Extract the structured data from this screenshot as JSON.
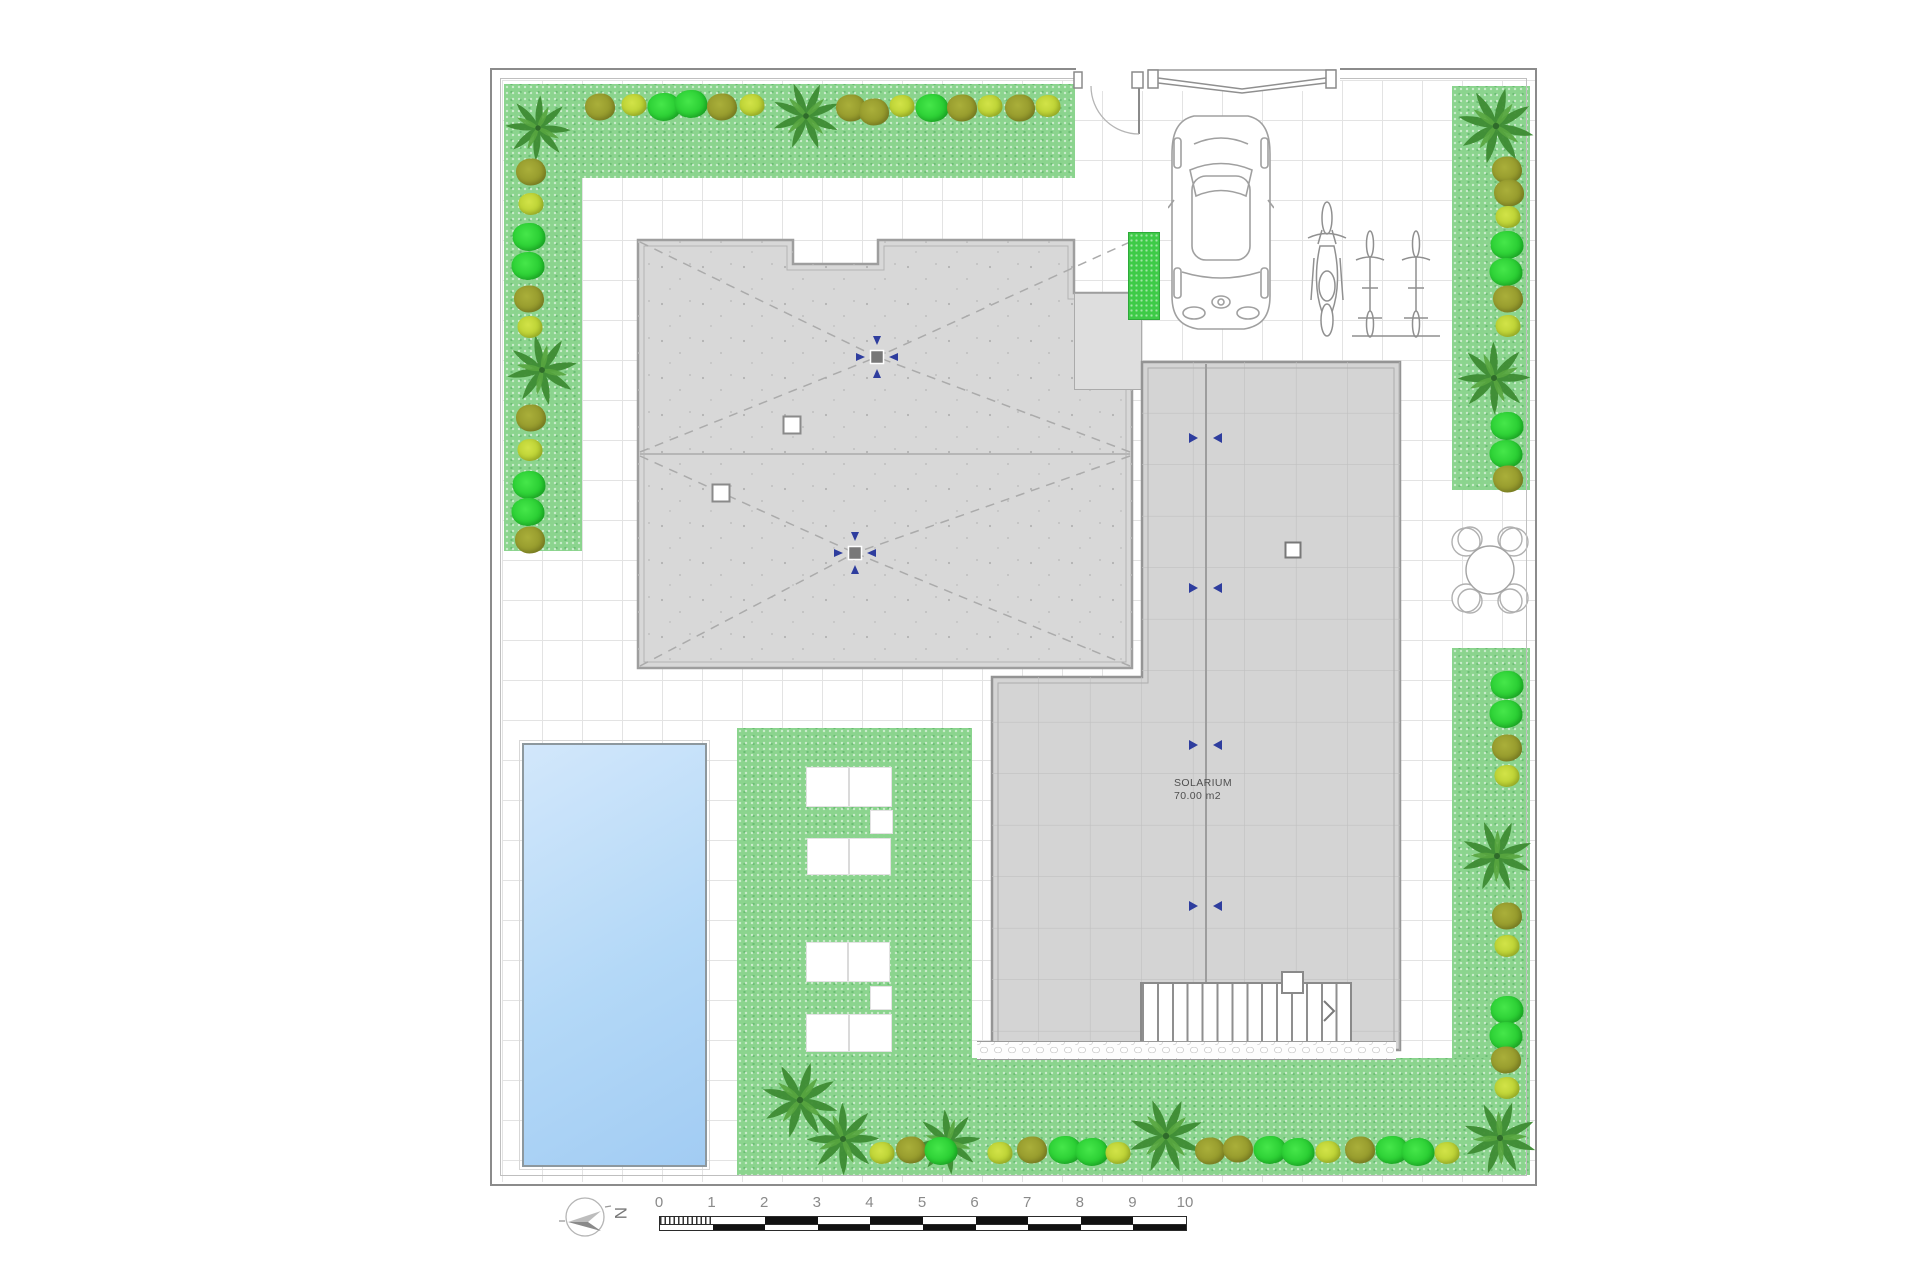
{
  "solarium": {
    "label": "SOLARIUM",
    "area": "70.00 m2"
  },
  "north": {
    "label": "N"
  },
  "scale_bar": {
    "ticks": [
      "0",
      "1",
      "2",
      "3",
      "4",
      "5",
      "6",
      "7",
      "8",
      "9",
      "10"
    ]
  },
  "colors": {
    "grass_green": "#8bd48e",
    "shrub_olive": "#98a02e",
    "shrub_lime": "#bdd334",
    "shrub_bright_green": "#2fd838",
    "palm_green": "#3e8c33",
    "pool_blue": "#b3d8f7",
    "roof_gray": "#d8d8d8",
    "terrace_gray": "#d4d4d4",
    "vent_arrow_blue": "#2e3d9e",
    "line_gray": "#8b8b8b"
  }
}
